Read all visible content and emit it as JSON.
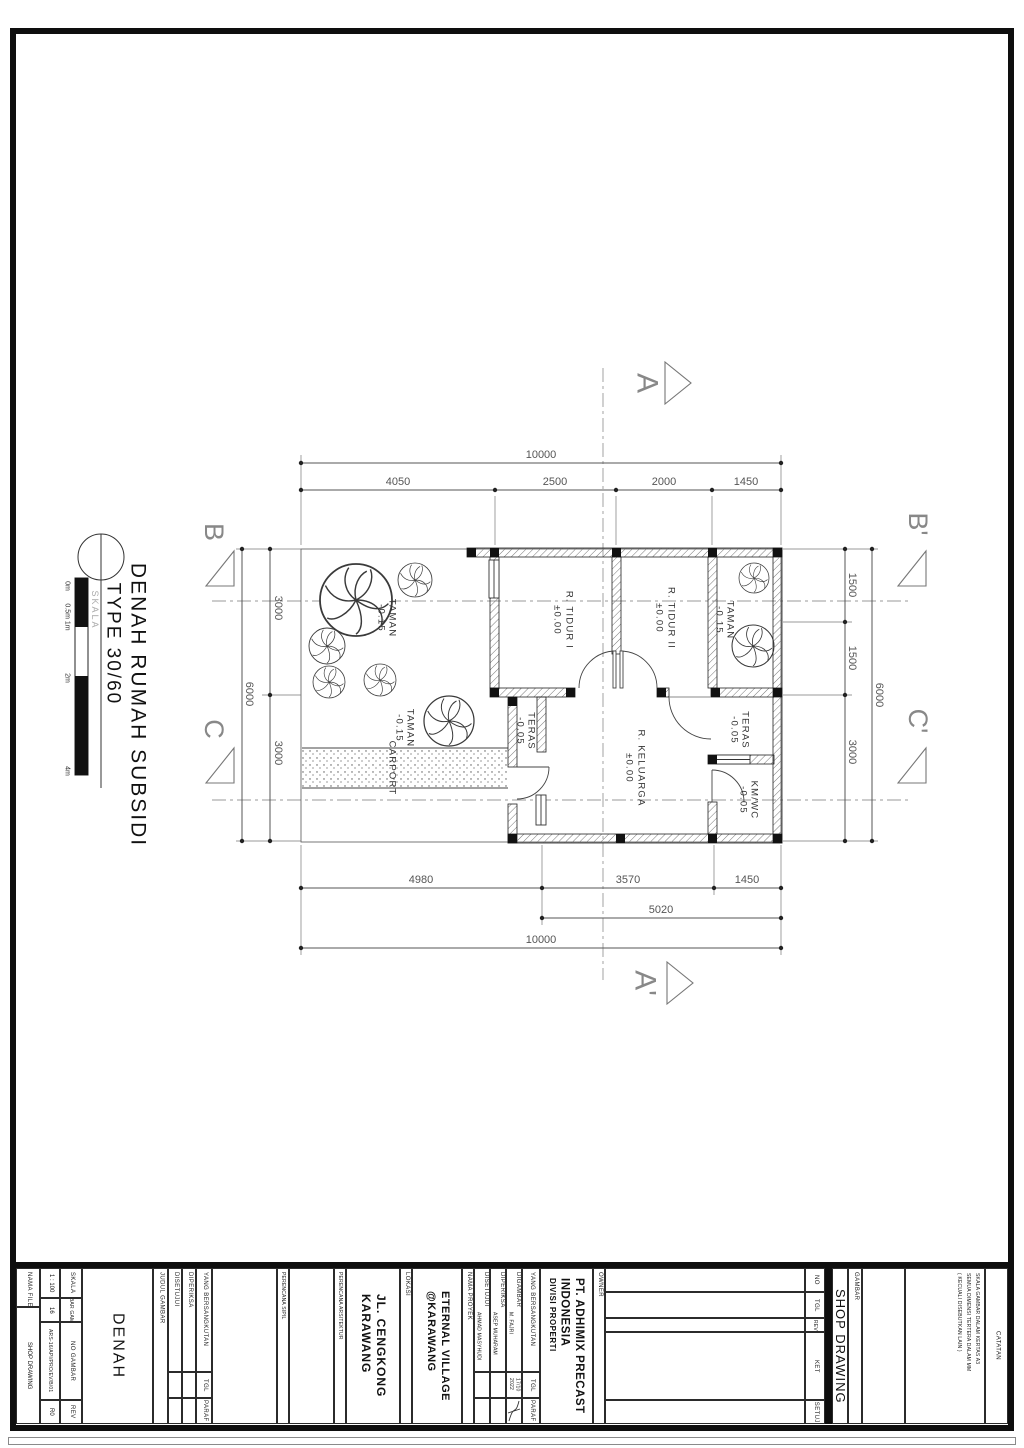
{
  "drawing": {
    "title_line1": "DENAH RUMAH SUBSIDI",
    "title_line2": "TYPE 30/60",
    "skala_caption": "SKALA",
    "scale_ticks": [
      "0m",
      "0.5m 1m",
      "2m",
      "4m"
    ],
    "rooms": {
      "tidur1": {
        "name": "R. TIDUR I",
        "level": "±0.00"
      },
      "tidur2": {
        "name": "R. TIDUR II",
        "level": "±0.00"
      },
      "keluarga": {
        "name": "R. KELUARGA",
        "level": "±0.00"
      },
      "teras_left": {
        "name": "TERAS",
        "level": "-0.05"
      },
      "teras_right": {
        "name": "TERAS",
        "level": "-0.05"
      },
      "kmwc": {
        "name": "KM/WC",
        "level": "-0.05"
      },
      "taman_left": {
        "name": "TAMAN",
        "level": "-0.15"
      },
      "taman_mid": {
        "name": "TAMAN",
        "level": "-0.15"
      },
      "taman_right": {
        "name": "TAMAN",
        "level": "-0.15"
      },
      "carport": {
        "name": "CARPORT"
      }
    },
    "dims": {
      "top_overall": "10000",
      "top": [
        "4050",
        "2500",
        "2000",
        "1450"
      ],
      "bottom": [
        "4980",
        "3570",
        "1450"
      ],
      "bottom_inner": "5020",
      "bottom_overall": "10000",
      "left": [
        "3000",
        "3000"
      ],
      "left_overall": "6000",
      "right": [
        "1500",
        "1500",
        "3000"
      ],
      "right_overall": "6000"
    },
    "sections": {
      "a": "A",
      "a2": "A'",
      "b": "B",
      "b2": "B'",
      "c": "C",
      "c2": "C'"
    }
  },
  "titleblock": {
    "nama_file_label": "NAMA FILE",
    "nama_file_value": "SHOP DRAWING",
    "skala_label": "SKALA",
    "skala_value": "1 : 100",
    "lembar_label": "LEMBAR GAMBAR",
    "lembar_value": "16",
    "no_gambar_label": "NO GAMBAR",
    "no_gambar_value": "ARS-16/API/PRO/EV/B/01",
    "rev_label": "REV",
    "rev_value": "R0",
    "judul_label": "JUDUL GAMBAR",
    "judul_value": "DENAH",
    "disetujui_label": "DISETUJUI",
    "diperiksa_label": "DIPERIKSA",
    "ybs_label": "YANG BERSANGKUTAN",
    "tgl_label": "TGL",
    "paraf_label": "PARAF",
    "perencana_sipil_label": "PERENCANA SIPIL",
    "perencana_arsitektur_label": "PERENCANA ARSITEKTUR",
    "lokasi_label": "LOKASI",
    "lokasi_line1": "JL. CENGKONG",
    "lokasi_line2": "KARAWANG",
    "proyek_label": "NAMA PROYEK",
    "proyek_line1": "ETERNAL VILLAGE",
    "proyek_line2": "@KARAWANG",
    "digambar_label": "DIGAMBAR",
    "digambar_value": "M. FAJRI",
    "diperiksa_value": "ASEP MUHARAM",
    "disetujui_value": "AHMAD MASYHUDI",
    "tgl_value_line1": "17/10",
    "tgl_value_line2": "2022",
    "owner_label": "OWNER",
    "owner_line1": "PT. ADHIMIX PRECAST",
    "owner_line2": "INDONESIA",
    "owner_line3": "DIVISI PROPERTI",
    "rev_no_label": "NO",
    "rev_tgl_label": "TGL",
    "rev_rev_label": "REV",
    "rev_ket_label": "KET",
    "rev_disetujui_label": "DISETUJUI",
    "gambar_label": "GAMBAR",
    "gambar_value": "SHOP DRAWING",
    "catatan_label": "CATATAN",
    "catatan_line1": "SKALA GAMBAR DALAM KERTAS A3",
    "catatan_line2": "SEMUA DIMENSI TERTERA DALAM MM",
    "catatan_line3": "( KECUALI DISEBUTKAN LAIN )"
  }
}
